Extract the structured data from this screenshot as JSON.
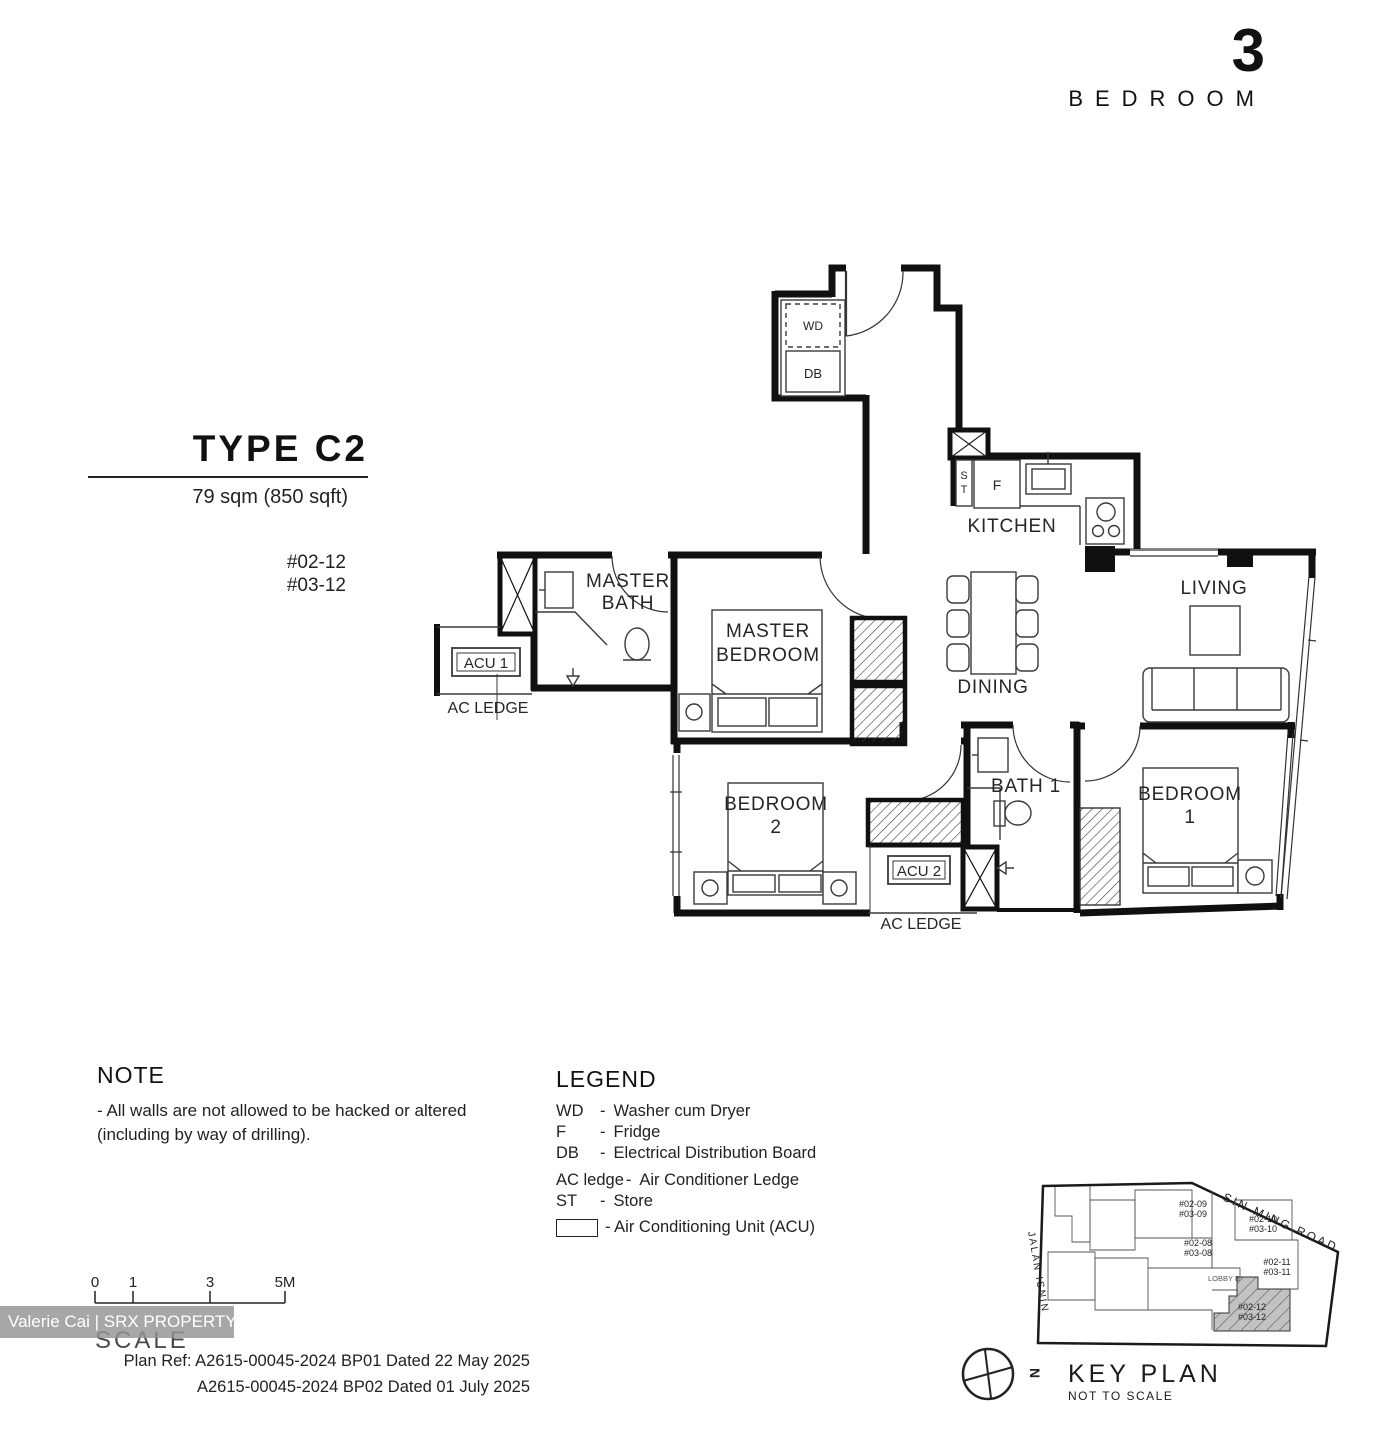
{
  "header": {
    "number": "3",
    "label": "BEDROOM"
  },
  "type_block": {
    "title": "TYPE C2",
    "area": "79 sqm (850 sqft)",
    "units": [
      "#02-12",
      "#03-12"
    ]
  },
  "floor_plan": {
    "rooms": {
      "kitchen": "KITCHEN",
      "living": "LIVING",
      "dining": "DINING",
      "master_bath_1": "MASTER",
      "master_bath_2": "BATH",
      "master_bedroom_1": "MASTER",
      "master_bedroom_2": "BEDROOM",
      "bedroom2_1": "BEDROOM",
      "bedroom2_2": "2",
      "bath1": "BATH 1",
      "bedroom1_1": "BEDROOM",
      "bedroom1_2": "1"
    },
    "fixtures": {
      "wd": "WD",
      "db": "DB",
      "st_s": "S",
      "st_t": "T",
      "fridge": "F",
      "acu1": "ACU 1",
      "acu2": "ACU 2",
      "ac_ledge_left": "AC LEDGE",
      "ac_ledge_bottom": "AC LEDGE"
    }
  },
  "note": {
    "title": "NOTE",
    "lines": [
      "-   All walls are not allowed to be hacked or altered",
      "(including by way of drilling)."
    ]
  },
  "legend": {
    "title": "LEGEND",
    "dash": "-",
    "items": [
      {
        "abbr": "WD",
        "desc": "Washer cum Dryer"
      },
      {
        "abbr": "F",
        "desc": "Fridge"
      },
      {
        "abbr": "DB",
        "desc": "Electrical Distribution Board"
      },
      {
        "abbr": "AC ledge",
        "desc": "Air Conditioner Ledge"
      },
      {
        "abbr": "ST",
        "desc": "Store"
      }
    ],
    "acu_item": "- Air Conditioning Unit (ACU)"
  },
  "scale_bar": {
    "labels": [
      "0",
      "1",
      "3",
      "5M"
    ],
    "caption": "SCALE"
  },
  "plan_ref": {
    "line1": "Plan Ref: A2615-00045-2024 BP01 Dated 22 May 2025",
    "line2": "A2615-00045-2024 BP02 Dated 01 July 2025"
  },
  "key_plan": {
    "title": "KEY PLAN",
    "subtitle": "NOT TO SCALE",
    "roads": {
      "top": "SIN MING ROAD",
      "left": "JALAN ISNIN"
    },
    "lobby": "LOBBY B",
    "north": "N",
    "highlight_color": "#c2c2c2",
    "units": {
      "u08": [
        "#02-08",
        "#03-08"
      ],
      "u09": [
        "#02-09",
        "#03-09"
      ],
      "u10": [
        "#02-10",
        "#03-10"
      ],
      "u11": [
        "#02-11",
        "#03-11"
      ],
      "u12": [
        "#02-12",
        "#03-12"
      ]
    }
  },
  "watermark": {
    "text": "Valerie Cai | SRX PROPERTY"
  }
}
